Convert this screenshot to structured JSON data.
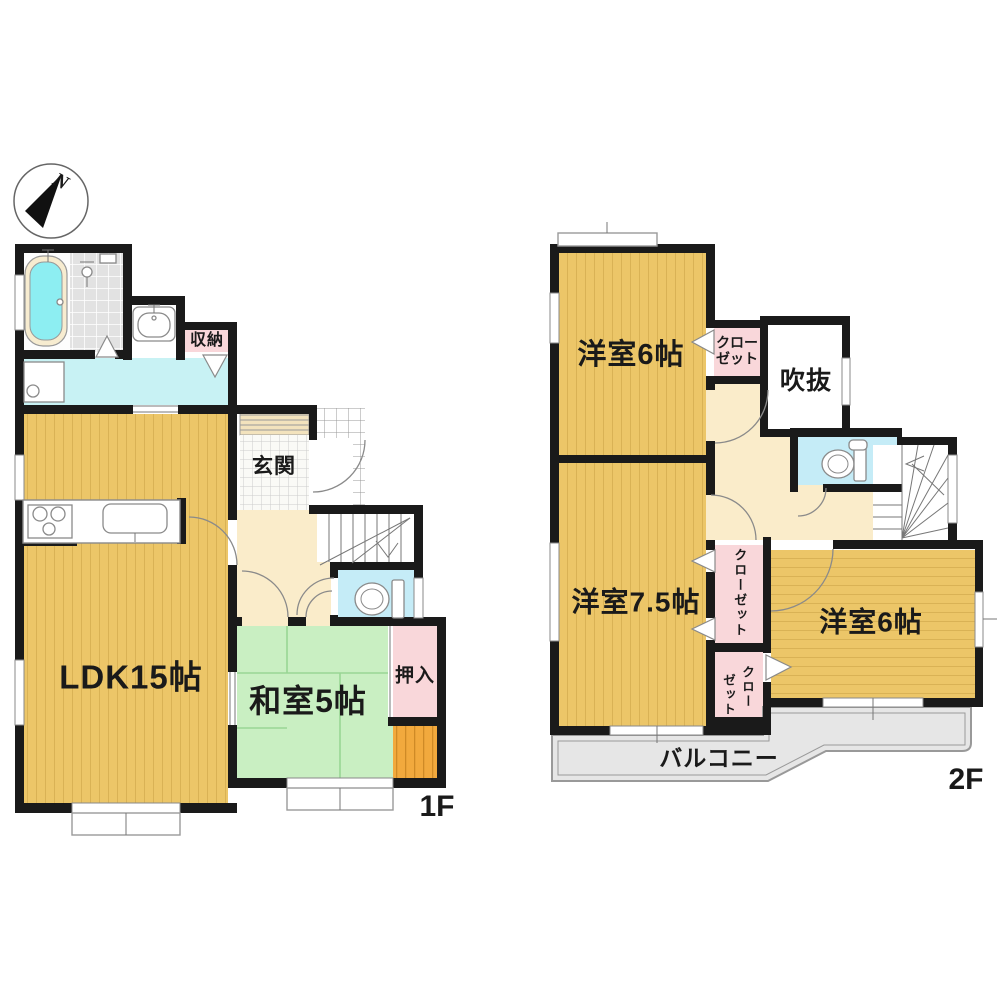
{
  "compass": {
    "north": "N"
  },
  "floor1": {
    "label": "1F",
    "rooms": {
      "storage": "収納",
      "entrance": "玄関",
      "ldk": "LDK15帖",
      "tatami": "和室5帖",
      "oshiire": "押入"
    }
  },
  "floor2": {
    "label": "2F",
    "rooms": {
      "bedroom_north": "洋室6帖",
      "closet_north_l1": "クロー",
      "closet_north_l2": "ゼット",
      "atrium": "吹抜",
      "bedroom_west": "洋室7.5帖",
      "closet_west": "クローゼット",
      "closet_south_c1": "クロー",
      "closet_south_c2": "ゼット",
      "bedroom_east": "洋室6帖",
      "balcony": "バルコニー"
    }
  },
  "colors": {
    "wall": "#1a1a1a",
    "wood_floor": "#ecc668",
    "tatami_green": "#c9efc2",
    "closet_pink": "#f9d7da",
    "water_cyan": "#c8f2f4",
    "hall_cream": "#faecca",
    "balcony_gray": "#e6e6e6",
    "deck_orange": "#f2a93d"
  }
}
